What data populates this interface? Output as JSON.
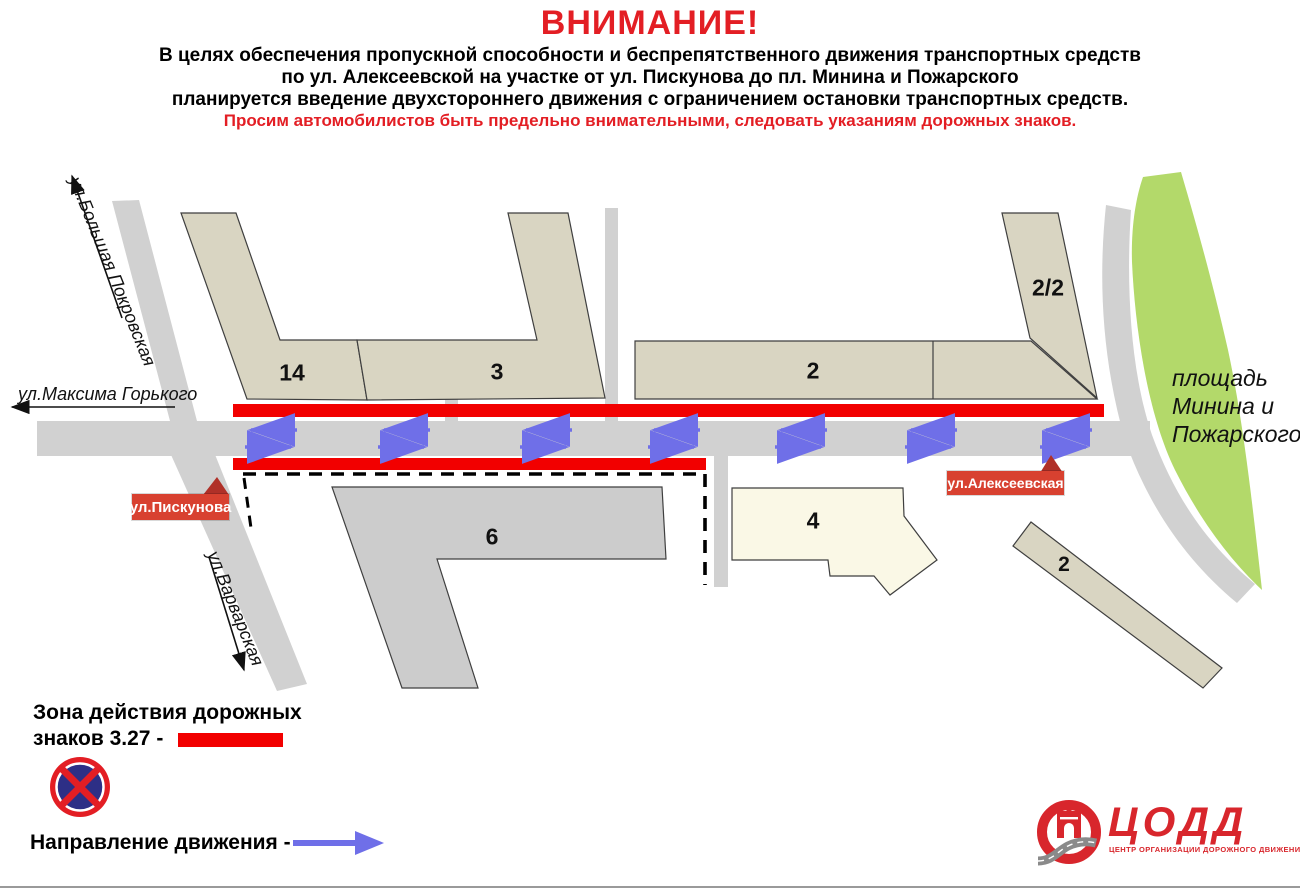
{
  "header": {
    "title": "ВНИМАНИЕ!",
    "line1": "В целях обеспечения пропускной способности и беспрепятственного движения транспортных средств",
    "line2": "по ул. Алексеевской на участке от ул. Пискунова до пл. Минина и Пожарского",
    "line3": "планируется введение двухстороннего движения с ограничением остановки транспортных средств.",
    "warning": "Просим автомобилистов быть предельно внимательными, следовать указаниям дорожных знаков."
  },
  "map": {
    "streets": {
      "bolshaya_pokrovskaya": "ул.Большая Покровская",
      "maksima_gorkogo": "ул.Максима Горького",
      "piskunova": "ул.Пискунова",
      "varvarskaya": "ул.Варварская",
      "alekseevskaya": "ул.Алексеевская"
    },
    "square": {
      "line1": "площадь",
      "line2": "Минина и",
      "line3": "Пожарского"
    },
    "buildings": {
      "b14": "14",
      "b3": "3",
      "b2": "2",
      "b2_2": "2/2",
      "b6": "6",
      "b4": "4",
      "b2s": "2"
    }
  },
  "legend": {
    "zone_line1": "Зона действия дорожных",
    "zone_line2": "знаков 3.27  -",
    "sign_name": "no-stopping-sign-3.27",
    "direction_label": "Направление движения -"
  },
  "logo": {
    "name": "ЦОДД",
    "tagline": "ЦЕНТР ОРГАНИЗАЦИИ ДОРОЖНОГО ДВИЖЕНИЯ"
  },
  "colors": {
    "red_zone": "#f20000",
    "accent_red": "#e31e24",
    "blue": "#6f6fe8",
    "green": "#b3d96a",
    "beige": "#d9d5c2",
    "road": "#d1d1d1",
    "building_gray": "#cccccc",
    "cream": "#faf8e6",
    "label_box": "#d84130",
    "marker_red": "#b03028",
    "logo_red": "#d8262c"
  }
}
